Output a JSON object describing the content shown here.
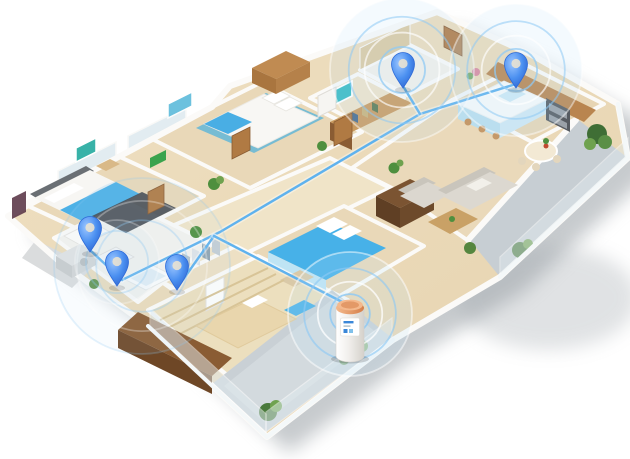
{
  "scene": {
    "subject": "3D isometric apartment floor plan with wireless location pins connected by blue lines to an outdoor heat-pump water-heater cylinder on the balcony",
    "width": 630,
    "height": 459,
    "background": "#ffffff"
  },
  "colors": {
    "pin_blue": "#4a8ff0",
    "pin_blue_dark": "#2f6bd8",
    "pin_highlight": "#9cc6ff",
    "pin_hole": "#e9e2d2",
    "line_blue": "#5fb2ee",
    "line_halo": "#ffffff",
    "ripple_blue": "#8ec9f4",
    "ripple_white": "#ffffff",
    "ripple_glow": "#bfe2f8",
    "device_body_light": "#ffffff",
    "device_body_dark": "#d5d1cb",
    "device_cap_light": "#f4b98d",
    "device_cap_dark": "#d57f49",
    "device_label_accent": "#3a87d8",
    "device_label_accent2": "#7fc0ea",
    "shadow": "#8f969c"
  },
  "pins": [
    {
      "id": "pin-washroom",
      "room": "washroom-vanity",
      "x": 90,
      "y": 228
    },
    {
      "id": "pin-bathroom",
      "room": "bathroom",
      "x": 117,
      "y": 262
    },
    {
      "id": "pin-closet-hall",
      "room": "walk-in-closet-hallway",
      "x": 177,
      "y": 266
    },
    {
      "id": "pin-toilet",
      "room": "toilet-room",
      "x": 403,
      "y": 64
    },
    {
      "id": "pin-kitchen",
      "room": "kitchen-counter",
      "x": 516,
      "y": 64
    }
  ],
  "connections": [
    {
      "id": "pipe-kitchen-main",
      "points": [
        [
          516,
          84
        ],
        [
          420,
          114
        ],
        [
          220,
          232
        ],
        [
          122,
          280
        ]
      ]
    },
    {
      "id": "pipe-toilet-branch",
      "points": [
        [
          403,
          86
        ],
        [
          420,
          114
        ]
      ]
    },
    {
      "id": "pipe-washroom-a",
      "points": [
        [
          90,
          250
        ],
        [
          122,
          280
        ]
      ]
    },
    {
      "id": "pipe-closet-c",
      "points": [
        [
          177,
          288
        ],
        [
          214,
          236
        ]
      ]
    },
    {
      "id": "pipe-to-device",
      "points": [
        [
          214,
          236
        ],
        [
          350,
          306
        ]
      ]
    }
  ],
  "ripples": [
    {
      "id": "ripple-toilet",
      "x": 402,
      "y": 70,
      "max_r": 72,
      "rings": 4,
      "opacity": 0.75
    },
    {
      "id": "ripple-kitchen",
      "x": 516,
      "y": 70,
      "max_r": 66,
      "rings": 4,
      "opacity": 0.75
    },
    {
      "id": "ripple-device",
      "x": 350,
      "y": 314,
      "max_r": 62,
      "rings": 4,
      "opacity": 0.85
    },
    {
      "id": "ripple-washrooms-large",
      "x": 142,
      "y": 266,
      "max_r": 88,
      "rings": 3,
      "opacity": 0.4
    },
    {
      "id": "ripple-bathroom-small",
      "x": 117,
      "y": 262,
      "max_r": 42,
      "rings": 2,
      "opacity": 0.45
    }
  ],
  "device": {
    "id": "heat-pump-water-heater",
    "x": 350,
    "y": 300,
    "radius": 14,
    "height": 56
  }
}
